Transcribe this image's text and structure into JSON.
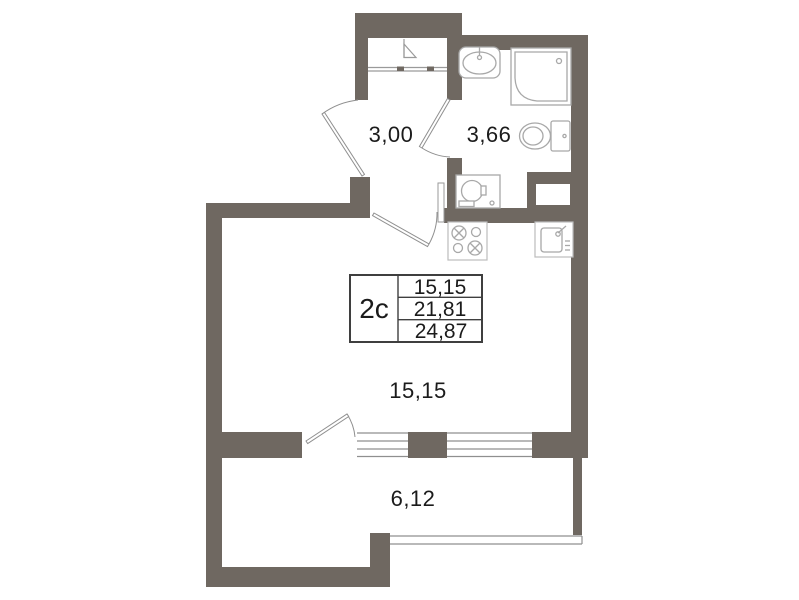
{
  "plan": {
    "unit_type": "2c",
    "rooms": [
      {
        "name": "hallway",
        "area": "3,00"
      },
      {
        "name": "bathroom",
        "area": "3,66"
      },
      {
        "name": "living-room",
        "area": "15,15"
      },
      {
        "name": "balcony",
        "area": "6,12"
      }
    ],
    "info_table": {
      "unit_type": "2c",
      "values": [
        "15,15",
        "21,81",
        "24,87"
      ]
    },
    "colors": {
      "wall": "#6f6861",
      "line": "#9a9a9a",
      "fixture": "#a8a8a8",
      "door": "#8f8f8f",
      "window": "#8f8f8f",
      "table-border": "#3f3f3f",
      "text": "#1b1b1b",
      "bg": "#ffffff"
    },
    "icons": [
      "hanger-icon",
      "bath-sink-icon",
      "shower-icon",
      "toilet-icon",
      "washing-machine-icon",
      "stove-icon",
      "kitchen-sink-icon"
    ]
  }
}
